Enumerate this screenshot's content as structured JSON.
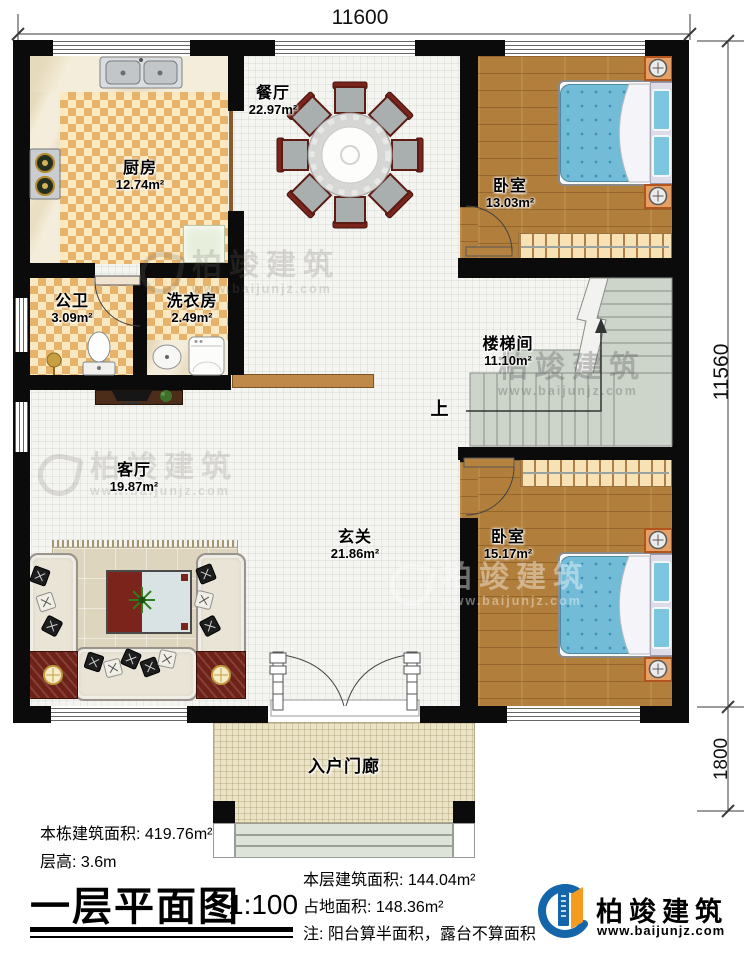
{
  "dimensions": {
    "top": "11600",
    "side": "11560",
    "porch": "1800"
  },
  "rooms": {
    "dining": {
      "name": "餐厅",
      "area": "22.97m²"
    },
    "kitchen": {
      "name": "厨房",
      "area": "12.74m²"
    },
    "bedroom_top": {
      "name": "卧室",
      "area": "13.03m²"
    },
    "bathroom": {
      "name": "公卫",
      "area": "3.09m²"
    },
    "laundry": {
      "name": "洗衣房",
      "area": "2.49m²"
    },
    "stairwell": {
      "name": "楼梯间",
      "area": "11.10m²",
      "direction": "上"
    },
    "living": {
      "name": "客厅",
      "area": "19.87m²"
    },
    "foyer": {
      "name": "玄关",
      "area": "21.86m²"
    },
    "bedroom_bottom": {
      "name": "卧室",
      "area": "15.17m²"
    },
    "porch": {
      "name": "入户门廊"
    }
  },
  "footer": {
    "total_area": "本栋建筑面积: 419.76m²",
    "floor_height": "层高: 3.6m",
    "title": "一层平面图",
    "scale": "1:100",
    "floor_area": "本层建筑面积: 144.04m²",
    "footprint_area": "占地面积: 148.36m²",
    "note": "注: 阳台算半面积，露台不算面积"
  },
  "brand": {
    "name": "柏竣建筑",
    "website": "www.baijunjz.com"
  },
  "colors": {
    "wall": "#0b0b0b",
    "wood": "#b17e3b",
    "checker": "#e7b269",
    "stair": "#cdd5cb",
    "brand_blue": "#1565ab",
    "brand_orange": "#f59b20"
  }
}
